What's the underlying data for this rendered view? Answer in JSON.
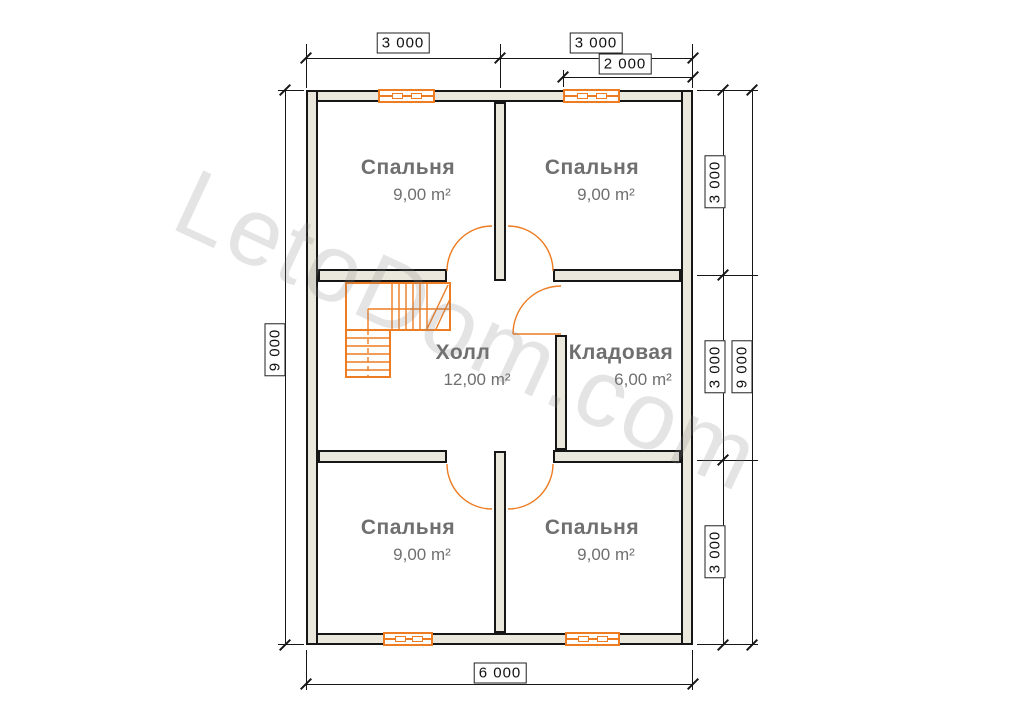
{
  "watermark": "LetoDom.com",
  "rooms": {
    "bedroom_top_left": {
      "name": "Спальня",
      "area": "9,00 m²"
    },
    "bedroom_top_right": {
      "name": "Спальня",
      "area": "9,00 m²"
    },
    "hall": {
      "name": "Холл",
      "area": "12,00 m²"
    },
    "storage": {
      "name": "Кладовая",
      "area": "6,00 m²"
    },
    "bedroom_bottom_left": {
      "name": "Спальня",
      "area": "9,00 m²"
    },
    "bedroom_bottom_right": {
      "name": "Спальня",
      "area": "9,00 m²"
    }
  },
  "dimensions": {
    "top_left_span": "3 000",
    "top_right_span": "3 000",
    "top_sub_span": "2 000",
    "left_total": "9 000",
    "right_seg_1": "3 000",
    "right_seg_2": "3 000",
    "right_seg_3": "3 000",
    "right_total": "9 000",
    "bottom_total": "6 000"
  },
  "colors": {
    "wall_fill": "#eae7dc",
    "wall_outline": "#161616",
    "fixture_orange": "#ed7c22",
    "room_label_gray": "#6f6f6f",
    "dimension_text": "#111111"
  }
}
